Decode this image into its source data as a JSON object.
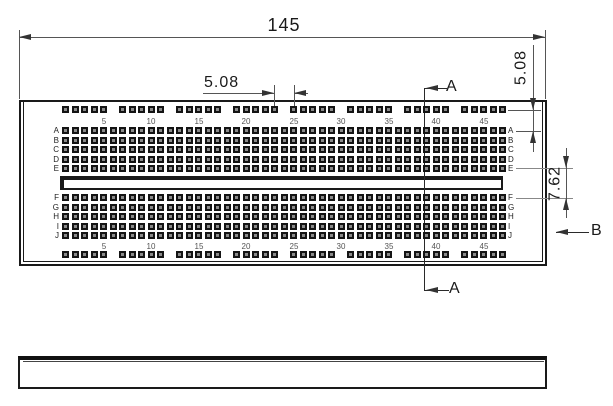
{
  "dimensions": {
    "board_width": "145",
    "rail_group_gap": "5.08",
    "rail_to_row_offset": "5.08",
    "channel_span": "7.62"
  },
  "section_markers": {
    "a_top": "A",
    "a_bottom": "A",
    "b_right": "B"
  },
  "row_labels_upper": [
    "A",
    "B",
    "C",
    "D",
    "E"
  ],
  "row_labels_lower": [
    "F",
    "G",
    "H",
    "I",
    "J"
  ],
  "column_numbers": [
    "5",
    "10",
    "15",
    "20",
    "25",
    "30",
    "35",
    "40",
    "45"
  ],
  "grid": {
    "columns": 47,
    "numbered_every": 5,
    "rail_groups": 8,
    "rail_holes_per_group": 5
  },
  "colors": {
    "outline": "#1a1a1a",
    "dimension_line": "#555555",
    "extension_line": "#888888",
    "hole": "#141414",
    "hole_center": "#8a8a8a",
    "column_number_text": "#555555",
    "row_label_text": "#222222"
  }
}
